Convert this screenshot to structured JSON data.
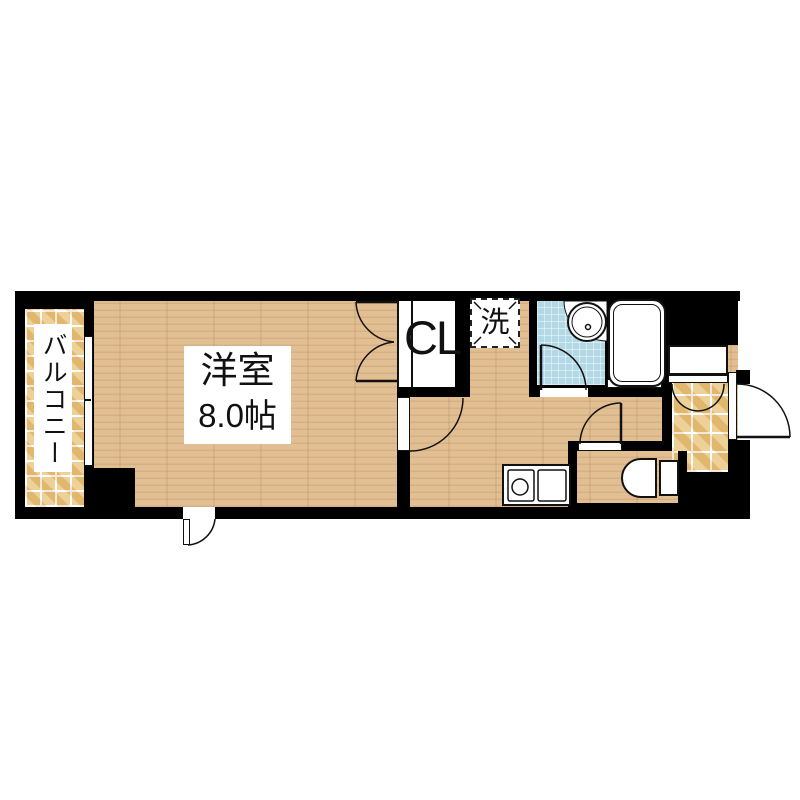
{
  "floorplan": {
    "type": "apartment-floorplan",
    "rooms": {
      "balcony": {
        "label": "バルコニー"
      },
      "main_room": {
        "name": "洋室",
        "size": "8.0帖"
      },
      "closet": {
        "label": "CL"
      },
      "laundry": {
        "label": "洗"
      }
    },
    "fixtures": [
      "bathtub",
      "wash-basin",
      "kitchen-sink",
      "toilet",
      "shoe-cabinet",
      "entrance-door",
      "balcony-window"
    ],
    "colors": {
      "wall": "#000000",
      "wood_floor": "#e2bf92",
      "balcony_tile": "#e9c37c",
      "bath_tile": "#b3d8e6",
      "fixture_fill": "#ffffff",
      "text": "#111111"
    }
  }
}
